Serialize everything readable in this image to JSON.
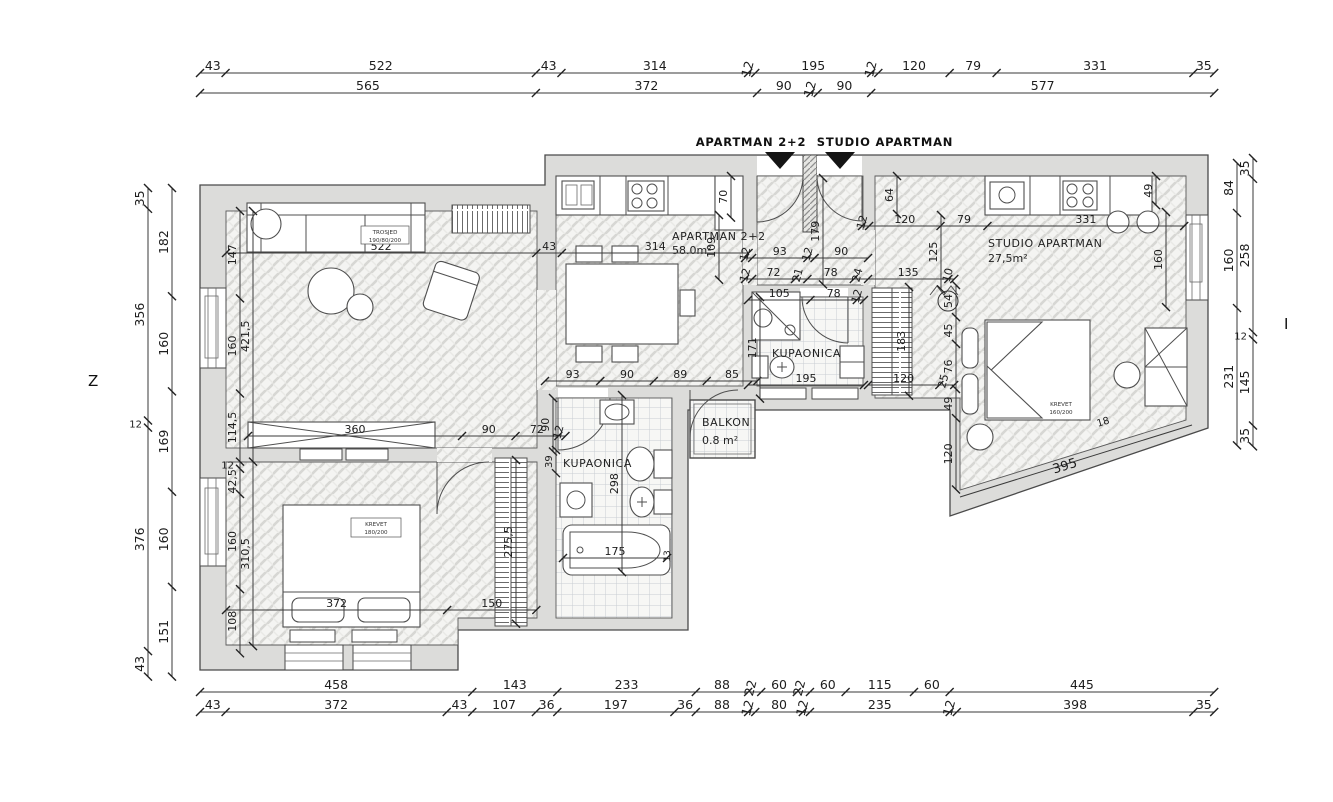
{
  "plan": {
    "scale": 0.5945,
    "ink": "#2e2e2e",
    "wall_color": "#dcdcda",
    "compass": {
      "west": "Z",
      "east": "I"
    },
    "entrance_markers": {
      "apartman": "APARTMAN 2+2",
      "studio": "STUDIO APARTMAN"
    },
    "rooms": {
      "apartman_name": "APARTMAN 2+2",
      "apartman_area": "58.0m²",
      "studio_name": "STUDIO APARTMAN",
      "studio_area": "27,5m²",
      "bath1": "KUPAONICA",
      "bath2": "KUPAONICA",
      "balkon_name": "BALKON",
      "balkon_area": "0.8 m²"
    },
    "furniture_labels": [
      {
        "lines": [
          "TROSJED",
          "190/80/200"
        ],
        "x": 385,
        "y": 234,
        "size": 5.6,
        "box": [
          361,
          226,
          48,
          18
        ]
      },
      {
        "lines": [
          "KREVET",
          "180/200"
        ],
        "x": 376,
        "y": 526,
        "size": 5.6,
        "box": [
          351,
          518,
          50,
          19
        ]
      },
      {
        "lines": [
          "KREVET",
          "160/200"
        ],
        "x": 1061,
        "y": 406,
        "size": 5.6
      }
    ],
    "chains": [
      {
        "n": "top-outer",
        "d": "h",
        "x": 200,
        "y": 73,
        "fs": 12.5,
        "v": [
          "43",
          "522",
          "43",
          "314",
          "12",
          "195",
          "12",
          "120",
          "79",
          "331",
          "35"
        ]
      },
      {
        "n": "top-inner",
        "d": "h",
        "x": 200,
        "y": 93,
        "fs": 12.5,
        "v": [
          "565",
          "372",
          "90",
          "12",
          "90",
          "577"
        ]
      },
      {
        "n": "bottom-upper",
        "d": "h",
        "x": 200,
        "y": 692,
        "fs": 12.5,
        "v": [
          "458",
          "143",
          "233",
          "88",
          "22",
          "60",
          "22",
          "60",
          "115",
          "60",
          "445"
        ]
      },
      {
        "n": "bottom-lower",
        "d": "h",
        "x": 200,
        "y": 712,
        "fs": 12.5,
        "v": [
          "43",
          "372",
          "43",
          "107",
          "36",
          "197",
          "36",
          "88",
          "12",
          "80",
          "12",
          "235",
          "12",
          "398",
          "35"
        ]
      },
      {
        "n": "left-outer",
        "d": "v",
        "x": 148,
        "y": 188,
        "fs": 12.5,
        "v": [
          "35",
          "356",
          "12",
          "376",
          "43"
        ]
      },
      {
        "n": "left-inner",
        "d": "v",
        "x": 172,
        "y": 188,
        "fs": 12.5,
        "v": [
          "182",
          "160",
          "169",
          "160",
          "151"
        ]
      },
      {
        "n": "right-inner",
        "d": "v",
        "x": 1237,
        "y": 163,
        "fs": 12.5,
        "v": [
          "84",
          "160",
          "231"
        ]
      },
      {
        "n": "right-outer",
        "d": "v",
        "x": 1253,
        "y": 158,
        "fs": 12.5,
        "v": [
          "35",
          "258",
          "12",
          "145",
          "35"
        ]
      },
      {
        "n": "living-top",
        "d": "h",
        "x": 226,
        "y": 253,
        "v": [
          "522",
          "43",
          "314"
        ]
      },
      {
        "n": "hall-upper",
        "d": "h",
        "x": 745,
        "y": 258,
        "v": [
          "12",
          "93",
          "12",
          "90"
        ]
      },
      {
        "n": "hall-lower",
        "d": "h",
        "x": 745,
        "y": 279,
        "v": [
          "12",
          "72",
          "21",
          "78",
          "24",
          "135",
          "10"
        ]
      },
      {
        "n": "studio-top",
        "d": "h",
        "x": 862,
        "y": 226,
        "v": [
          "12",
          "120",
          "79",
          "331"
        ]
      },
      {
        "n": "bath1-top",
        "d": "h",
        "x": 545,
        "y": 381,
        "v": [
          "93",
          "90",
          "89",
          "85"
        ]
      },
      {
        "n": "wardrobe-row",
        "d": "h",
        "x": 248,
        "y": 436,
        "v": [
          "360",
          "90",
          "72",
          "12"
        ]
      },
      {
        "n": "bath2-top",
        "d": "h",
        "x": 748,
        "y": 300,
        "v": [
          "105",
          "78",
          "12"
        ]
      },
      {
        "n": "bath2-bottom",
        "d": "h",
        "x": 748,
        "y": 385,
        "v": [
          "195"
        ]
      },
      {
        "n": "bath2-right",
        "d": "h",
        "x": 868,
        "y": 385,
        "v": [
          "120",
          "25"
        ]
      },
      {
        "n": "tub",
        "d": "h",
        "x": 563,
        "y": 558,
        "v": [
          "175"
        ]
      },
      {
        "n": "bed-bottom",
        "d": "h",
        "x": 226,
        "y": 610,
        "v": [
          "372",
          "150"
        ]
      },
      {
        "n": "left-room-a",
        "d": "v",
        "x": 240,
        "y": 211,
        "v": [
          "147",
          "160",
          "114,5",
          "12",
          "42,5",
          "160",
          "108"
        ]
      },
      {
        "n": "left-room-b",
        "d": "v",
        "x": 253,
        "y": 211,
        "v": [
          "421,5",
          "310,5"
        ]
      },
      {
        "n": "kitchen-left",
        "d": "v",
        "x": 719,
        "y": 215,
        "v": [
          "109"
        ]
      },
      {
        "n": "cupboard",
        "d": "v",
        "x": 731,
        "y": 176,
        "v": [
          "70"
        ]
      },
      {
        "n": "entry-door",
        "d": "v",
        "x": 823,
        "y": 178,
        "v": [
          "179"
        ]
      },
      {
        "n": "studio-door",
        "d": "v",
        "x": 897,
        "y": 176,
        "v": [
          "64"
        ]
      },
      {
        "n": "studio-left",
        "d": "v",
        "x": 941,
        "y": 215,
        "v": [
          "125"
        ]
      },
      {
        "n": "studio-right",
        "d": "v",
        "x": 1166,
        "y": 212,
        "v": [
          "160"
        ]
      },
      {
        "n": "studio-tr",
        "d": "v",
        "x": 1156,
        "y": 176,
        "v": [
          "49"
        ]
      },
      {
        "n": "studio-part",
        "d": "v",
        "x": 956,
        "y": 285,
        "v": [
          "54",
          "45",
          "76",
          "49",
          "120"
        ],
        "c": [
          0
        ]
      },
      {
        "n": "bath2-rv",
        "d": "v",
        "x": 909,
        "y": 287,
        "v": [
          "183"
        ]
      },
      {
        "n": "bath2-lv",
        "d": "v",
        "x": 760,
        "y": 297,
        "v": [
          "171"
        ]
      },
      {
        "n": "bath1-mid",
        "d": "v",
        "x": 622,
        "y": 395,
        "v": [
          "298"
        ]
      },
      {
        "n": "wardrobe2",
        "d": "v",
        "x": 516,
        "y": 460,
        "v": [
          "275,5"
        ]
      },
      {
        "n": "bath1-door",
        "d": "v",
        "x": 553,
        "y": 398,
        "v": [
          "90"
        ]
      },
      {
        "n": "niche",
        "d": "v",
        "x": 556,
        "y": 450,
        "v": [
          "39"
        ],
        "fs": 10
      }
    ],
    "free_dims": [
      {
        "t": "395",
        "x": 1066,
        "y": 470,
        "r": -17,
        "fs": 13
      },
      {
        "t": "18",
        "x": 1104,
        "y": 425,
        "r": -17,
        "fs": 10
      },
      {
        "t": "13",
        "x": 670,
        "y": 556,
        "r": -90,
        "fs": 9
      }
    ],
    "free_lines": [
      {
        "x1": 960,
        "y1": 497,
        "x2": 1192,
        "y2": 425
      }
    ]
  }
}
